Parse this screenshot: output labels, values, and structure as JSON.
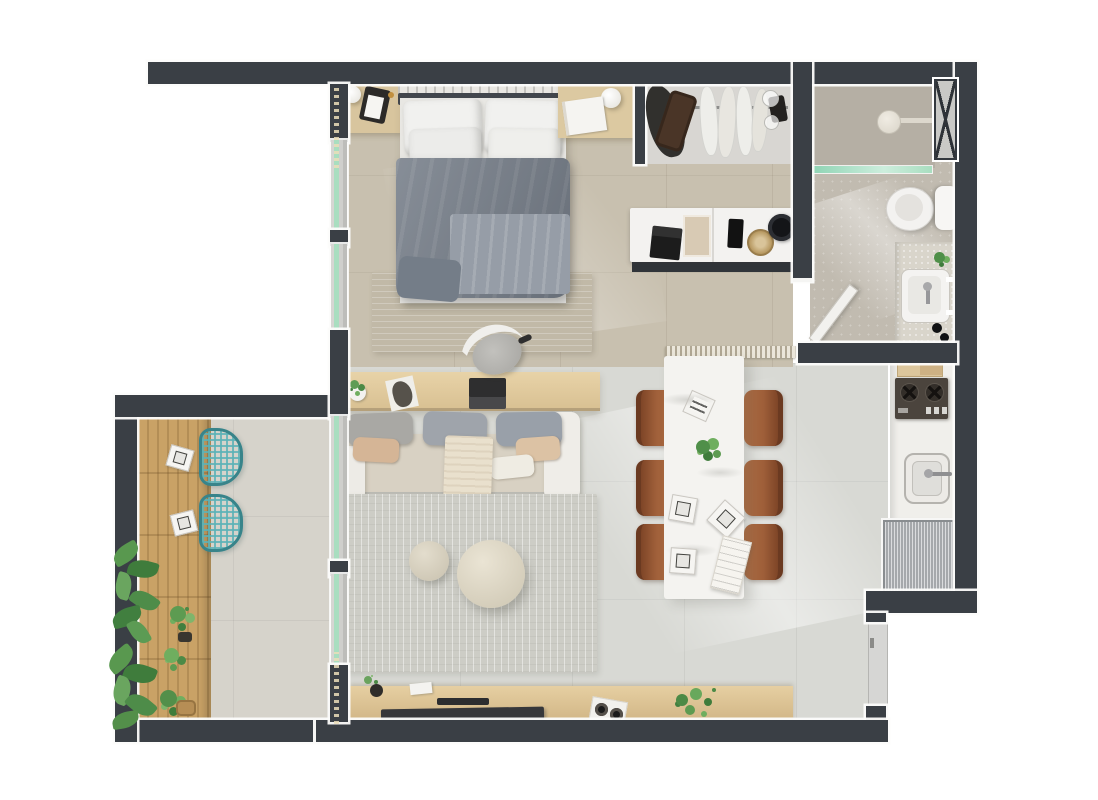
{
  "image": {
    "type": "3D-rendered apartment floor plan, top-down view",
    "width_px": 1098,
    "height_px": 800,
    "background": "#ffffff"
  },
  "palette": {
    "wall": "#3a3f45",
    "wall_outline": "#fbfbfa",
    "bedroom_floor": "#c8c0af",
    "living_floor": "#d8d9d4",
    "bathroom_floor": "#c1bbb0",
    "shower_floor": "#b5afa4",
    "balcony_floor": "#d6d3cb",
    "wood_deck": "#c9a266",
    "wood_desk": "#e2cda2",
    "wood_console": "#dcc092",
    "sofa_seat": "#d8d1c3",
    "rug": "#cdcdc6",
    "duvet_gray": "#7e8792",
    "dining_table_marble": "#f4f3f0",
    "chair_leather": "#a0603a",
    "stool_teal": "#5cb2b7",
    "plant_green": "#5c9b54",
    "fridge_steel": "#b6b9bc",
    "glass_green": "#a9dec0",
    "fixture_white": "#f3f2f0"
  },
  "rooms": [
    {
      "name": "bedroom",
      "furniture": [
        "double bed with white pillows and gray duvet",
        "two wooden nightstands with round lamps",
        "beige area rug",
        "open wardrobe with rail and hanging clothes",
        "white dresser with laptop, trays, woven plate and bowl"
      ]
    },
    {
      "name": "bathroom",
      "furniture": [
        "walk-in shower with glass partition and wall shower head",
        "hatched service shaft",
        "toilet",
        "vanity counter with sink, plant and bottles",
        "open swing door"
      ]
    },
    {
      "name": "living-room",
      "furniture": [
        "wooden desk with office chair, laptop, sculpture and potted plant",
        "three-seat sofa with gray and tan cushions and cream throw",
        "two round knit poufs",
        "large gray rug",
        "wooden TV sideboard with TV, white tray with speakers, books and fern"
      ]
    },
    {
      "name": "dining-area",
      "furniture": [
        "white marble rectangular table",
        "six brown leather chairs",
        "striped plate",
        "square plates",
        "menu card",
        "green plant centerpiece",
        "ribbed runner strip"
      ]
    },
    {
      "name": "kitchen",
      "furniture": [
        "marble counter",
        "cutting boards",
        "two-burner cooktop with knobs",
        "square sink with faucet",
        "stainless refrigerator",
        "entry door"
      ]
    },
    {
      "name": "balcony",
      "furniture": [
        "wooden bar counter on deck",
        "two teal wire bar stools",
        "two white plates",
        "potted plants and woven basket",
        "overhanging monstera leaves"
      ]
    }
  ],
  "watermark": {
    "present": true,
    "legible": false
  }
}
